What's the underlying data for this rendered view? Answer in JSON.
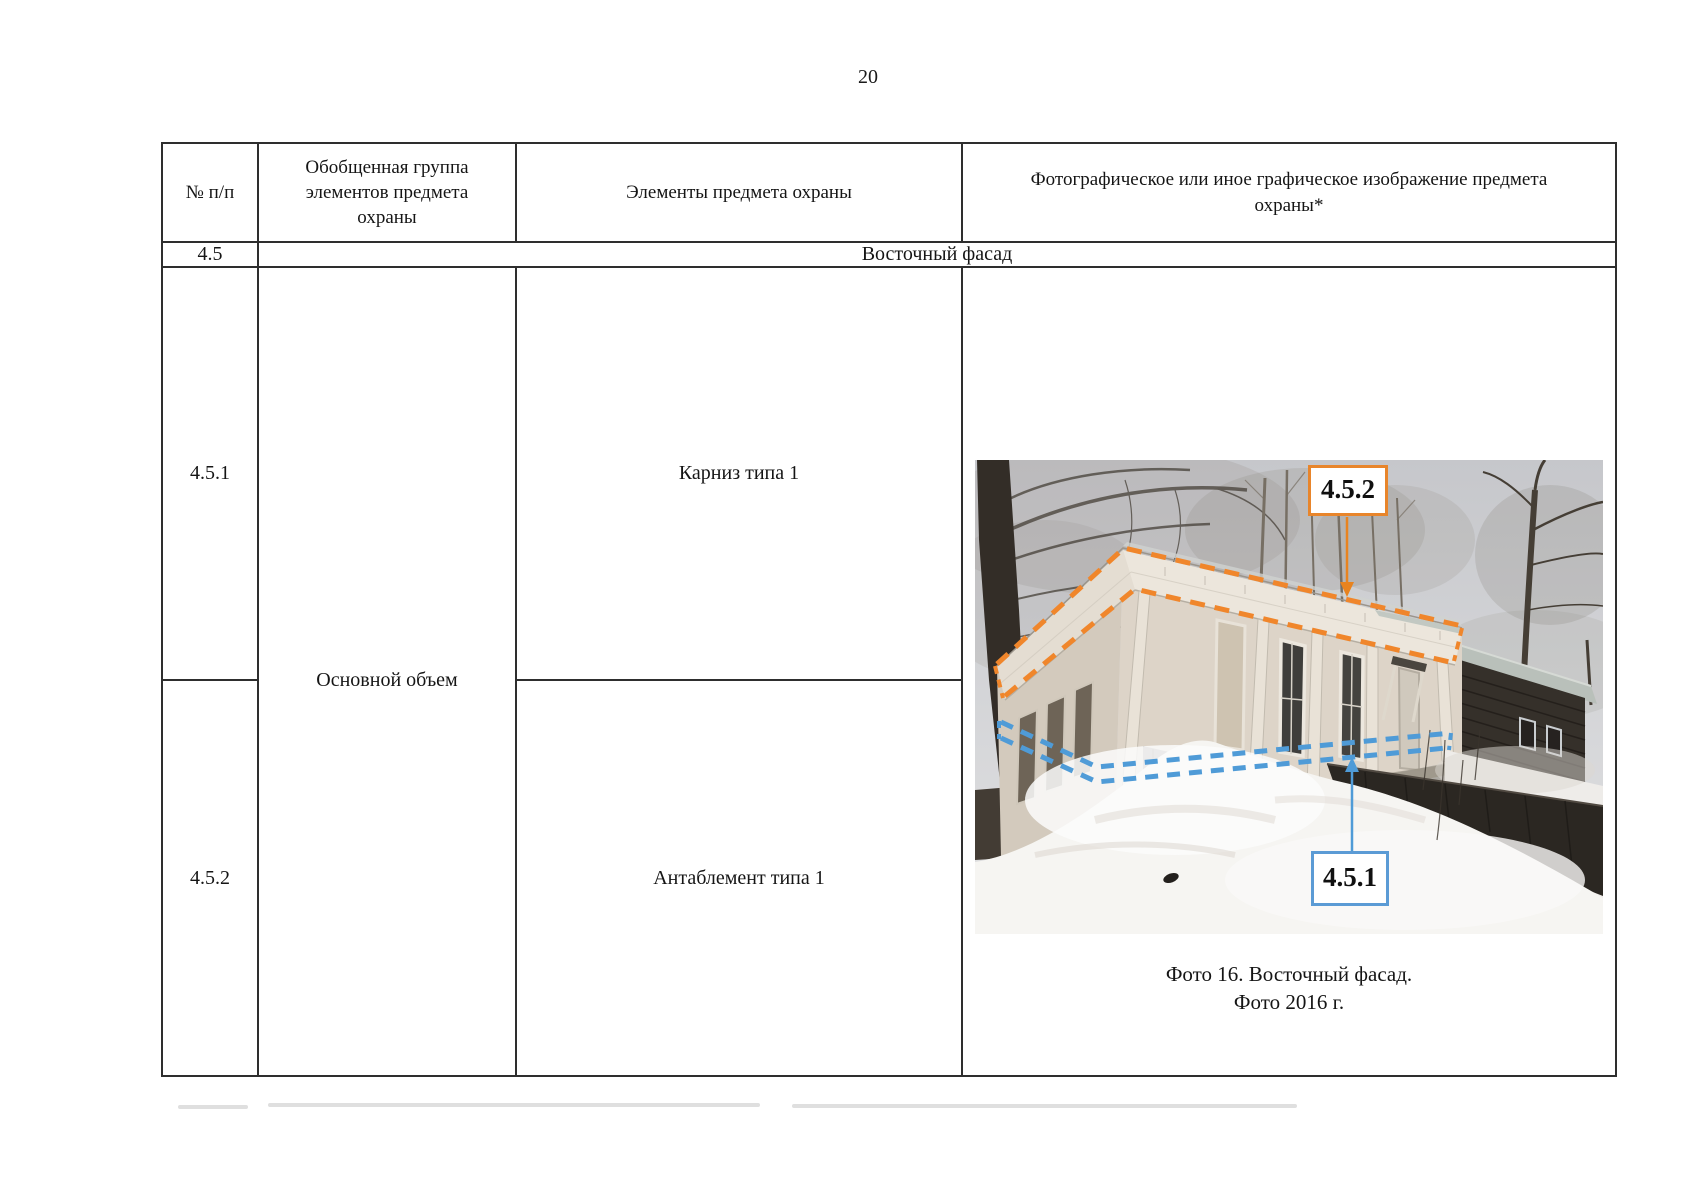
{
  "page": {
    "number": "20"
  },
  "table": {
    "headers": {
      "col1": "№ п/п",
      "col2": "Обобщенная группа элементов предмета охраны",
      "col3": "Элементы предмета охраны",
      "col4": "Фотографическое или иное графическое изображение предмета охраны*"
    },
    "section": {
      "number": "4.5",
      "title": "Восточный фасад"
    },
    "group": "Основной объем",
    "rows": [
      {
        "number": "4.5.1",
        "element": "Карниз типа 1"
      },
      {
        "number": "4.5.2",
        "element": "Антаблемент типа 1"
      }
    ]
  },
  "photo": {
    "caption_line1": "Фото 16. Восточный фасад.",
    "caption_line2": "Фото 2016 г.",
    "annotations": [
      {
        "label": "4.5.2",
        "color": "#E8852B"
      },
      {
        "label": "4.5.1",
        "color": "#5B9BD5"
      }
    ]
  },
  "colors": {
    "annotation_orange": "#F0862B",
    "annotation_blue": "#4F9BD7",
    "table_border": "#2E2E2E",
    "row_divider_gray": "#8F8F8F"
  }
}
